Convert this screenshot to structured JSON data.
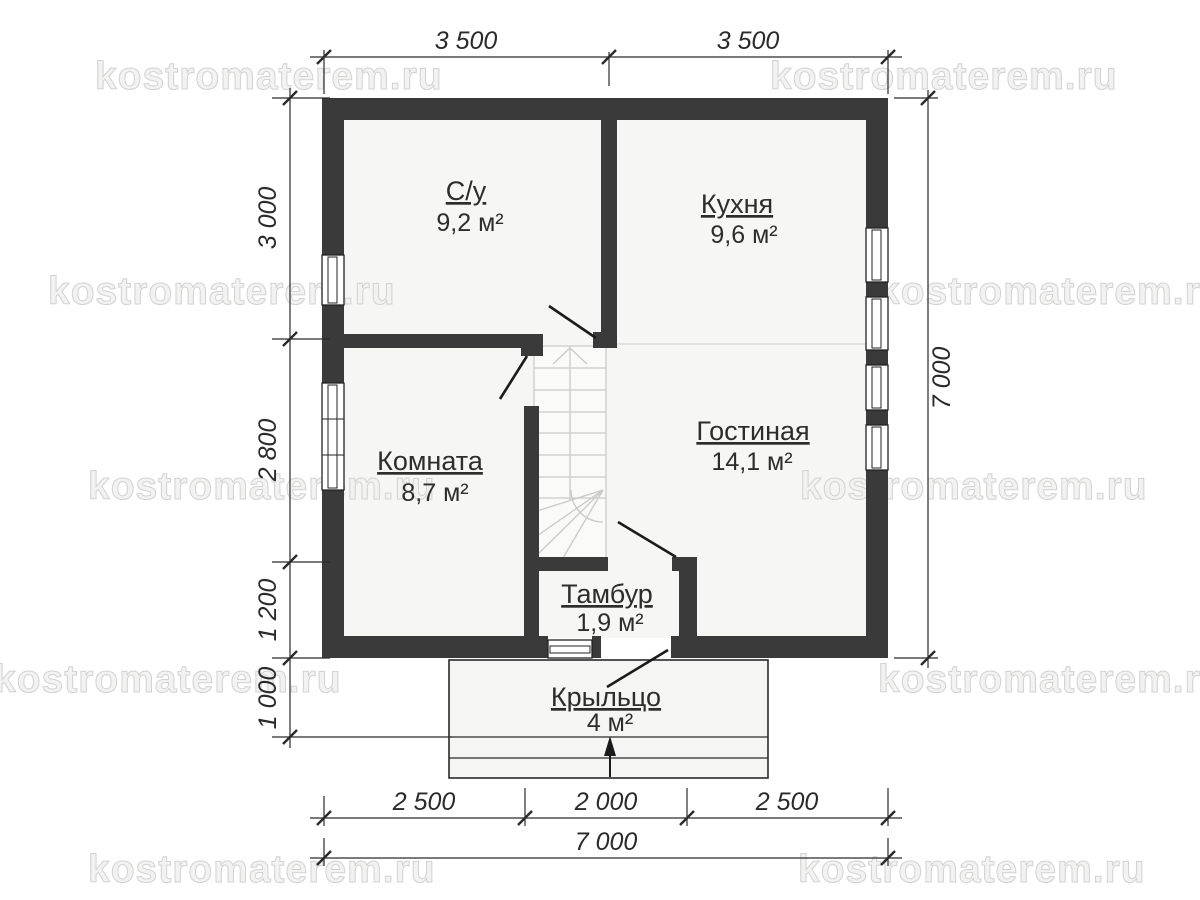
{
  "title": "floor-plan",
  "watermark": {
    "text": "kostromaterem.ru"
  },
  "rooms": {
    "su": {
      "name": "С/у",
      "area": "9,2 м²"
    },
    "kitchen": {
      "name": "Кухня",
      "area": "9,6 м²"
    },
    "room": {
      "name": "Комната",
      "area": "8,7 м²"
    },
    "living": {
      "name": "Гостиная",
      "area": "14,1 м²"
    },
    "tambour": {
      "name": "Тамбур",
      "area": "1,9 м²"
    },
    "porch": {
      "name": "Крыльцо",
      "area": "4 м²"
    }
  },
  "dimensions": {
    "top": {
      "d1": "3 500",
      "d2": "3 500"
    },
    "left": {
      "d1": "3 000",
      "d2": "2 800",
      "d3": "1 200",
      "d4": "1 000"
    },
    "right": {
      "total": "7 000"
    },
    "bottom": {
      "d1": "2 500",
      "d2": "2 000",
      "d3": "2 500",
      "total": "7 000"
    }
  },
  "colors": {
    "wall": "#3a3a3a",
    "floor": "#f6f6f4",
    "dimension_text": "#2a2a2a",
    "watermark": "#f2f2f1",
    "stair_lines": "#c9c9c9"
  }
}
